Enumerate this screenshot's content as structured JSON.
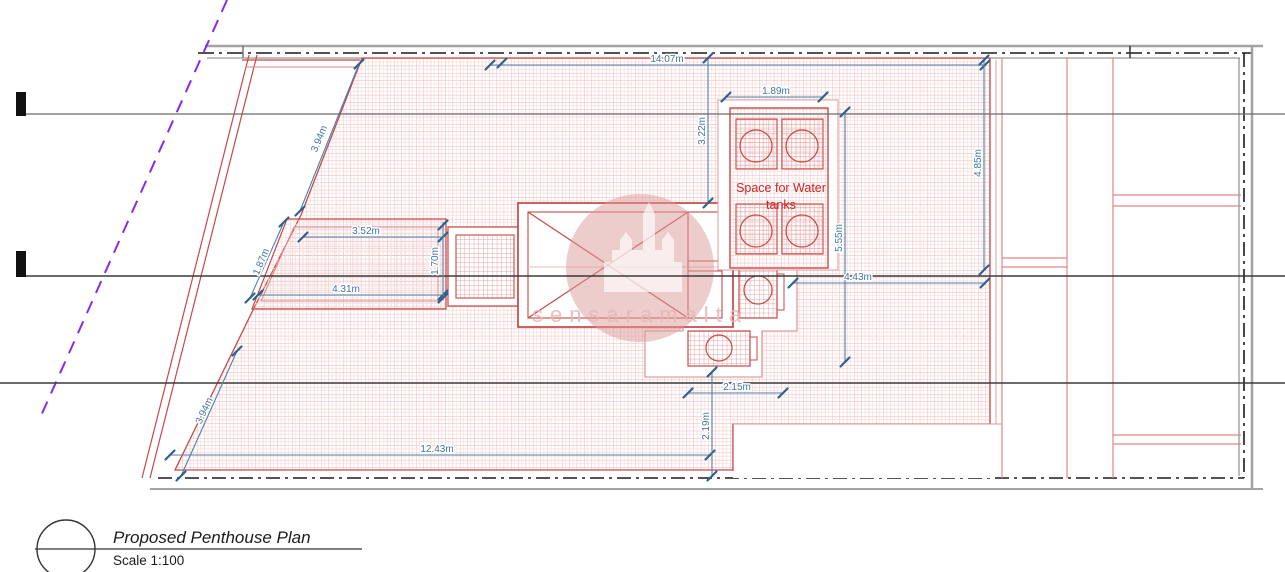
{
  "drawing": {
    "title": "Proposed Penthouse Plan",
    "scale": "Scale 1:100",
    "watermark": "sensaramalta",
    "annotations": {
      "water_tanks_line1": "Space for Water",
      "water_tanks_line2": "tanks"
    },
    "dimensions": {
      "dim_14_07": "14.07m",
      "dim_3_22": "3.22m",
      "dim_1_89": "1.89m",
      "dim_4_85": "4.85m",
      "dim_5_55": "5.55m",
      "dim_4_43": "4.43m",
      "dim_3_52": "3.52m",
      "dim_4_31": "4.31m",
      "dim_1_70": "1.70m",
      "dim_1_87": "1.87m",
      "dim_3_94_top": "3.94m",
      "dim_3_94_bottom": "3.94m",
      "dim_12_43": "12.43m",
      "dim_2_15": "2.15m",
      "dim_2_19": "2.19m"
    },
    "colors": {
      "plan_red": "#c64848",
      "hatch_pink": "#ecb4b4",
      "dimension_blue": "#42759f",
      "boundary_purple": "#8a2be2",
      "watermark_pink": "#dc9a9a"
    }
  }
}
